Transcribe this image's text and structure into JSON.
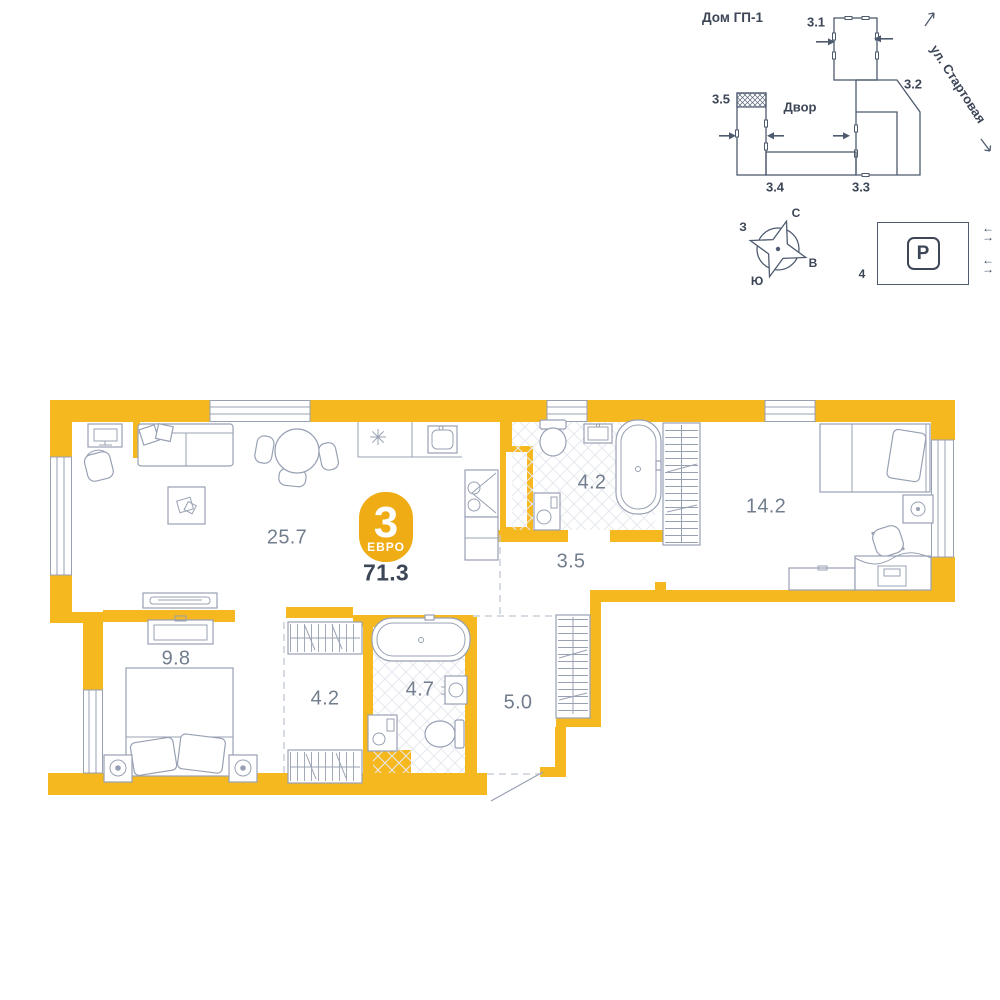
{
  "site_plan": {
    "title": "Дом ГП-1",
    "courtyard": "Двор",
    "street": "ул. Стартовая",
    "buildings": {
      "b1": "3.1",
      "b2": "3.2",
      "b3": "3.3",
      "b4": "3.4",
      "b5": "3.5"
    }
  },
  "compass": {
    "north": "С",
    "east": "В",
    "south": "Ю",
    "west": "З"
  },
  "parking": {
    "letter": "P",
    "lot_number": "4",
    "arrow_left": "←",
    "arrow_right": "→"
  },
  "apartment": {
    "badge_rooms": "3",
    "badge_type": "ЕВРО",
    "total_area": "71.3",
    "rooms": {
      "living_kitchen": "25.7",
      "bathroom_top": "4.2",
      "hallway_inner": "3.5",
      "bedroom_right": "14.2",
      "bedroom_left": "9.8",
      "wardrobe": "4.2",
      "bathroom_bottom": "4.7",
      "hallway_entrance": "5.0"
    }
  },
  "colors": {
    "wall": "#F6B81F",
    "badge": "#EFAC14",
    "furniture_line": "#98A1B3",
    "plan_dark": "#4E5A6E",
    "text_dark": "#3C4657",
    "text_muted": "#727E8D"
  }
}
